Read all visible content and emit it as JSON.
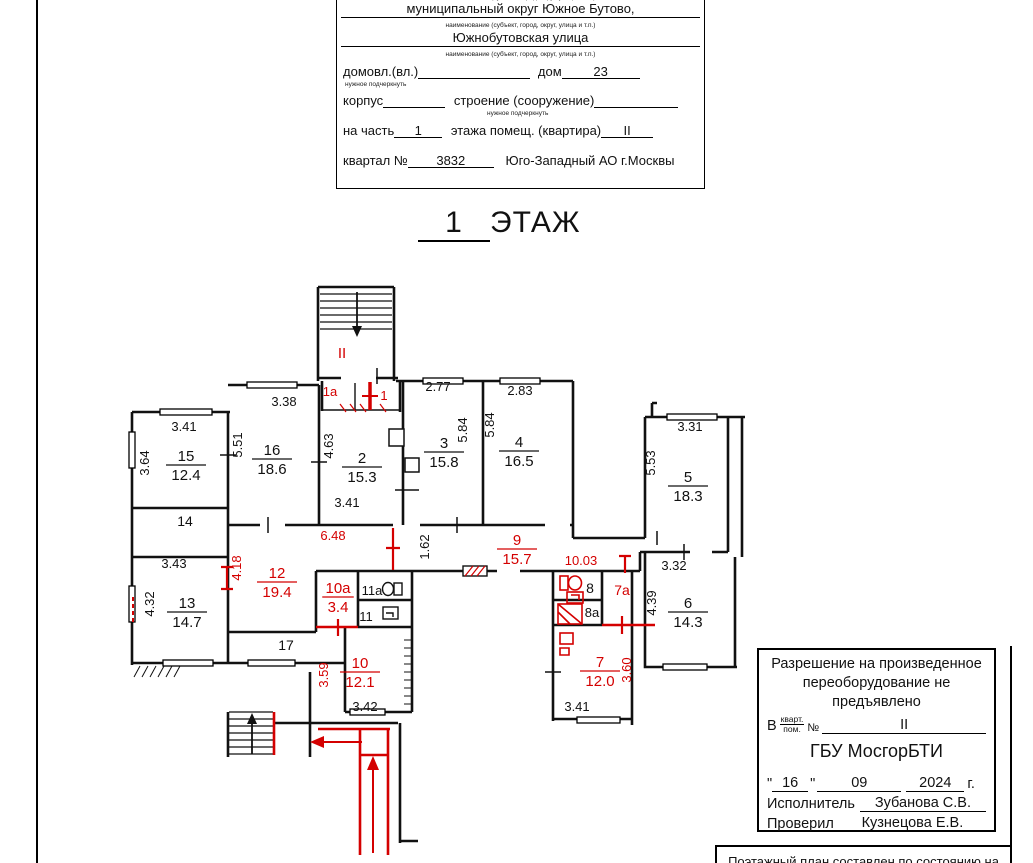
{
  "form": {
    "caption_name": "наименование (субъект, город, округ, улица и т.п.)",
    "line1": "муниципальный округ Южное Бутово,",
    "line2": "Южнобутовская улица",
    "domvl_label": "домовл.(вл.)",
    "dom_label": "дом",
    "dom_value": "23",
    "underline_note": "нужное подчеркнуть",
    "korpus_label": "корпус",
    "stroenie_label": "строение (сооружение)",
    "part_label": "на часть",
    "part_value": "1",
    "floor_label": "этажа помещ. (квартира)",
    "floor_value": "II",
    "kvartal_label": "квартал №",
    "kvartal_value": "3832",
    "okrug": "Юго-Западный АО г.Москвы"
  },
  "title": {
    "num": "1",
    "word": "ЭТАЖ"
  },
  "plan": {
    "colors": {
      "red": "#d40000",
      "ink": "#111111"
    },
    "rooms": [
      {
        "num": "15",
        "area": "12.4",
        "x": 186,
        "y": 465
      },
      {
        "num": "16",
        "area": "18.6",
        "x": 272,
        "y": 459
      },
      {
        "num": "13",
        "area": "14.7",
        "x": 187,
        "y": 612
      },
      {
        "num": "2",
        "area": "15.3",
        "x": 362,
        "y": 467
      },
      {
        "num": "3",
        "area": "15.8",
        "x": 444,
        "y": 452
      },
      {
        "num": "4",
        "area": "16.5",
        "x": 519,
        "y": 451
      },
      {
        "num": "5",
        "area": "18.3",
        "x": 688,
        "y": 486
      },
      {
        "num": "6",
        "area": "14.3",
        "x": 688,
        "y": 612
      },
      {
        "num": "9",
        "area": "15.7",
        "x": 517,
        "y": 549,
        "c": "r"
      },
      {
        "num": "12",
        "area": "19.4",
        "x": 277,
        "y": 582,
        "c": "r"
      },
      {
        "num": "10a",
        "area": "3.4",
        "x": 338,
        "y": 597,
        "c": "r"
      },
      {
        "num": "10",
        "area": "12.1",
        "x": 360,
        "y": 672,
        "c": "r"
      },
      {
        "num": "7",
        "area": "12.0",
        "x": 600,
        "y": 671,
        "c": "r"
      }
    ],
    "dims": [
      {
        "t": "3.41",
        "x": 184,
        "y": 431
      },
      {
        "t": "3.64",
        "x": 149,
        "y": 463,
        "rot": -90
      },
      {
        "t": "3.38",
        "x": 284,
        "y": 406
      },
      {
        "t": "5.51",
        "x": 242,
        "y": 445,
        "rot": -90
      },
      {
        "t": "3.43",
        "x": 174,
        "y": 568
      },
      {
        "t": "4.32",
        "x": 154,
        "y": 604,
        "rot": -90
      },
      {
        "t": "2.77",
        "x": 438,
        "y": 391
      },
      {
        "t": "5.84",
        "x": 467,
        "y": 430,
        "rot": -90
      },
      {
        "t": "2.83",
        "x": 520,
        "y": 395
      },
      {
        "t": "5.84",
        "x": 494,
        "y": 425,
        "rot": -90
      },
      {
        "t": "4.63",
        "x": 333,
        "y": 446,
        "rot": -90
      },
      {
        "t": "3.41",
        "x": 347,
        "y": 507
      },
      {
        "t": "3.31",
        "x": 690,
        "y": 431
      },
      {
        "t": "5.53",
        "x": 655,
        "y": 463,
        "rot": -90
      },
      {
        "t": "3.32",
        "x": 674,
        "y": 570
      },
      {
        "t": "4.39",
        "x": 656,
        "y": 603,
        "rot": -90
      },
      {
        "t": "1.62",
        "x": 429,
        "y": 547,
        "rot": -90
      },
      {
        "t": "3.42",
        "x": 365,
        "y": 711
      },
      {
        "t": "3.41",
        "x": 577,
        "y": 711
      },
      {
        "t": "14",
        "x": 185,
        "y": 526,
        "s": 14
      },
      {
        "t": "17",
        "x": 286,
        "y": 650,
        "s": 14
      },
      {
        "t": "11a",
        "x": 372,
        "y": 595,
        "s": 13
      },
      {
        "t": "11",
        "x": 366,
        "y": 621,
        "s": 13
      },
      {
        "t": "8",
        "x": 590,
        "y": 593,
        "s": 14
      },
      {
        "t": "8a",
        "x": 592,
        "y": 617,
        "s": 13
      },
      {
        "t": "6.48",
        "x": 333,
        "y": 540,
        "c": "r"
      },
      {
        "t": "10.03",
        "x": 581,
        "y": 565,
        "c": "r"
      },
      {
        "t": "4.18",
        "x": 241,
        "y": 568,
        "rot": -90,
        "c": "r"
      },
      {
        "t": "3.59",
        "x": 328,
        "y": 675,
        "rot": -90,
        "c": "r"
      },
      {
        "t": "3.60",
        "x": 631,
        "y": 670,
        "rot": -90,
        "c": "r"
      },
      {
        "t": "7a",
        "x": 622,
        "y": 595,
        "s": 14,
        "c": "r"
      },
      {
        "t": "1a",
        "x": 330,
        "y": 396,
        "s": 13,
        "c": "r"
      },
      {
        "t": "1",
        "x": 384,
        "y": 400,
        "s": 13,
        "c": "r"
      },
      {
        "t": "II",
        "x": 342,
        "y": 358,
        "s": 15,
        "c": "r"
      }
    ]
  },
  "stamp": {
    "line1": "Разрешение на произведенное",
    "line2": "переоборудование не предъявлено",
    "v_label": "В",
    "kvart": "кварт.",
    "pom": "пом.",
    "no_sign": "№",
    "value": "II",
    "org": "ГБУ МосгорБТИ",
    "q": "\"",
    "day": "16",
    "month": "09",
    "year": "2024",
    "year_suffix": "г.",
    "executor_label": "Исполнитель",
    "executor": "Зубанова С.В.",
    "checker_label": "Проверил",
    "checker": "Кузнецова Е.В."
  },
  "bottom_note": "Поэтажный план составлен по состоянию на"
}
